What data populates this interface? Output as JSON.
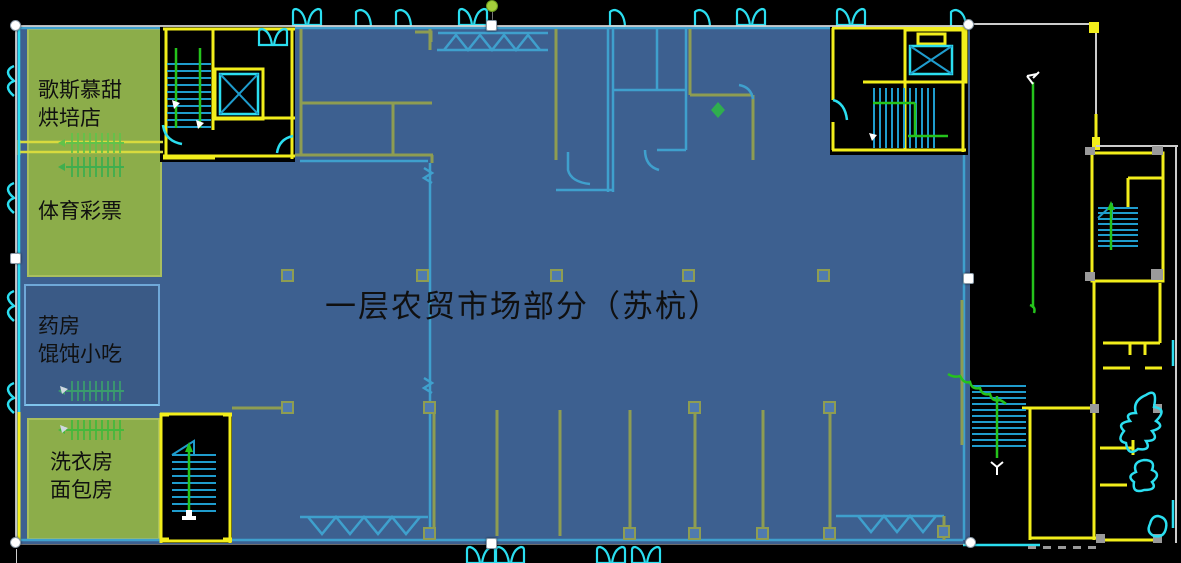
{
  "window": {
    "width": 1181,
    "height": 563
  },
  "floorplan": {
    "title": "一层农贸市场部分（苏杭）",
    "shops": [
      {
        "name": "bakery-shop",
        "lines": [
          "歌斯慕甜",
          "烘培店"
        ]
      },
      {
        "name": "sports-lottery",
        "lines": [
          "体育彩票"
        ]
      },
      {
        "name": "pharmacy-wonton",
        "lines": [
          "药房",
          "馄饨小吃"
        ]
      },
      {
        "name": "laundry-bread",
        "lines": [
          "洗衣房",
          "面包房"
        ]
      }
    ]
  },
  "palette": {
    "background": "#000000",
    "overlay_blue": "#3d6090",
    "overlay_blue_dark": "#3a5a86",
    "overlay_border": "#6fa8d8",
    "highlight_green": "#8cad4a",
    "highlight_green_border": "#a9bf5e",
    "cad_yellow": "#f2ee1b",
    "cad_cyan": "#2bdef0",
    "cad_blue": "#1f9ccd",
    "cad_green": "#25c31c",
    "cad_gray": "#cccccc",
    "muted_olive": "#8e9d52",
    "muted_cyan": "#3fa0cd",
    "muted_green": "#45b83c",
    "muted_yellow_band": "#cdd23f",
    "column_fill": "#4f7ab0",
    "text_color": "#101010",
    "handle_fill": "#ffffff",
    "handle_stroke": "#8a9aa8",
    "rotate_handle": "#a4cf3b"
  },
  "icons": {
    "corner_handle": "resize-corner-handle",
    "mid_handle": "resize-mid-handle",
    "rotate": "rotate-handle",
    "stairs": "stair-run-icon",
    "elevator": "elevator-x-icon",
    "door": "door-swing-icon",
    "escalator": "escalator-icon",
    "exit_arrow": "exit-path-arrow"
  }
}
